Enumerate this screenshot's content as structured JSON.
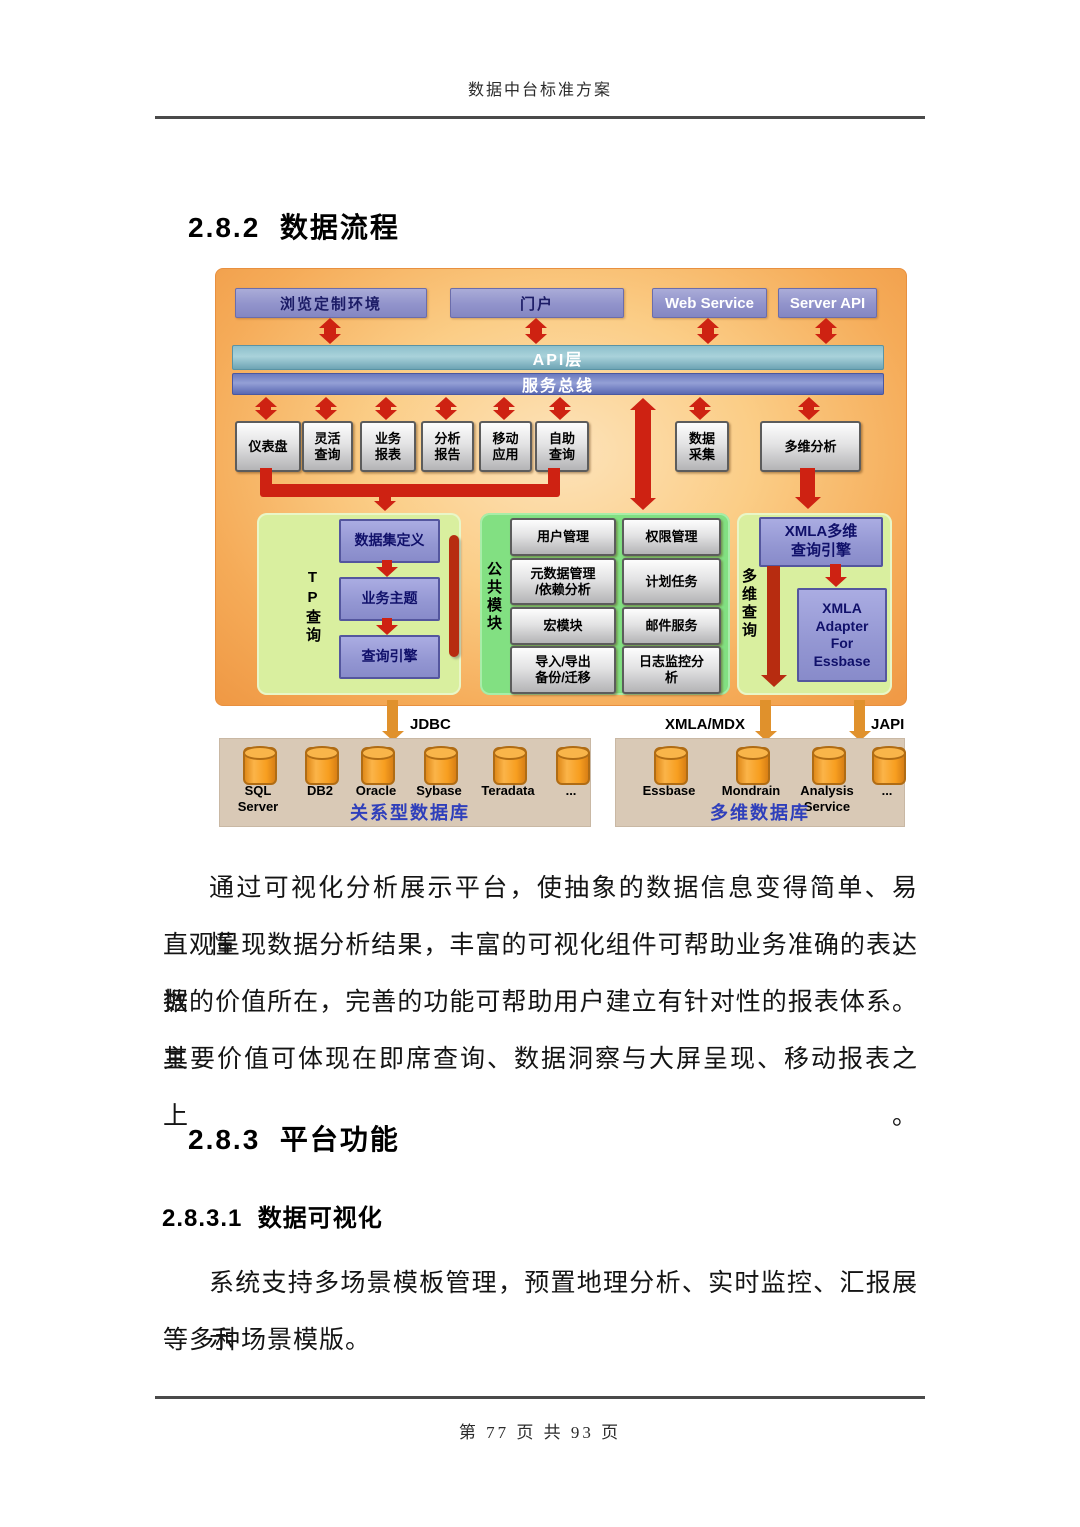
{
  "page": {
    "header_title": "数据中台标准方案",
    "footer_text": "第 77 页 共 93 页"
  },
  "headings": {
    "s282": "2.8.2  数据流程",
    "s283": "2.8.3  平台功能",
    "s2831": "2.8.3.1  数据可视化"
  },
  "paragraphs": {
    "p1_lines": [
      "通过可视化分析展示平台，使抽象的数据信息变得简单、易懂，",
      "直观呈现数据分析结果，丰富的可视化组件可帮助业务准确的表达数",
      "据的价值所在，完善的功能可帮助用户建立有针对性的报表体系。其",
      "主要价值可体现在即席查询、数据洞察与大屏呈现、移动报表之上。"
    ],
    "p2_lines": [
      "系统支持多场景模板管理，预置地理分析、实时监控、汇报展示",
      "等多种场景模版。"
    ]
  },
  "diagram": {
    "top_boxes": [
      "浏览定制环境",
      "门户",
      "Web Service",
      "Server API"
    ],
    "api_layer_label": "API层",
    "service_bus_label": "服务总线",
    "app_boxes": [
      "仪表盘",
      "灵活\n查询",
      "业务\n报表",
      "分析\n报告",
      "移动\n应用",
      "自助\n查询",
      "数据\n采集",
      "多维分析"
    ],
    "tp_panel": {
      "title": "TP查询",
      "boxes": [
        "数据集定义",
        "业务主题",
        "查询引擎"
      ]
    },
    "common_panel": {
      "title": "公共模块",
      "col1": [
        "用户管理",
        "元数据管理\n/依赖分析",
        "宏模块",
        "导入/导出\n备份/迁移"
      ],
      "col2": [
        "权限管理",
        "计划任务",
        "邮件服务",
        "日志监控分\n析"
      ]
    },
    "md_panel": {
      "title": "多维查询",
      "engine_box": "XMLA多维\n查询引擎",
      "adapter_box": "XMLA\nAdapter\nFor\nEssbase"
    },
    "connector_labels": {
      "jdbc": "JDBC",
      "xmla_mdx": "XMLA/MDX",
      "japi": "JAPI"
    },
    "db_left": {
      "items": [
        "SQL\nServer",
        "DB2",
        "Oracle",
        "Sybase",
        "Teradata",
        "..."
      ],
      "caption": "关系型数据库"
    },
    "db_right": {
      "items": [
        "Essbase",
        "Mondrain",
        "Analysis\nService",
        "..."
      ],
      "caption": "多维数据库"
    },
    "colors": {
      "arrow_red": "#ce2212",
      "bar_dark_red": "#b72c10",
      "arrow_orange": "#e0912c",
      "caption_blue": "#2f3fbb",
      "panel_light_green": "#d9ef9f",
      "panel_green": "#82e082",
      "diagram_orange": "#f5ab58"
    }
  }
}
